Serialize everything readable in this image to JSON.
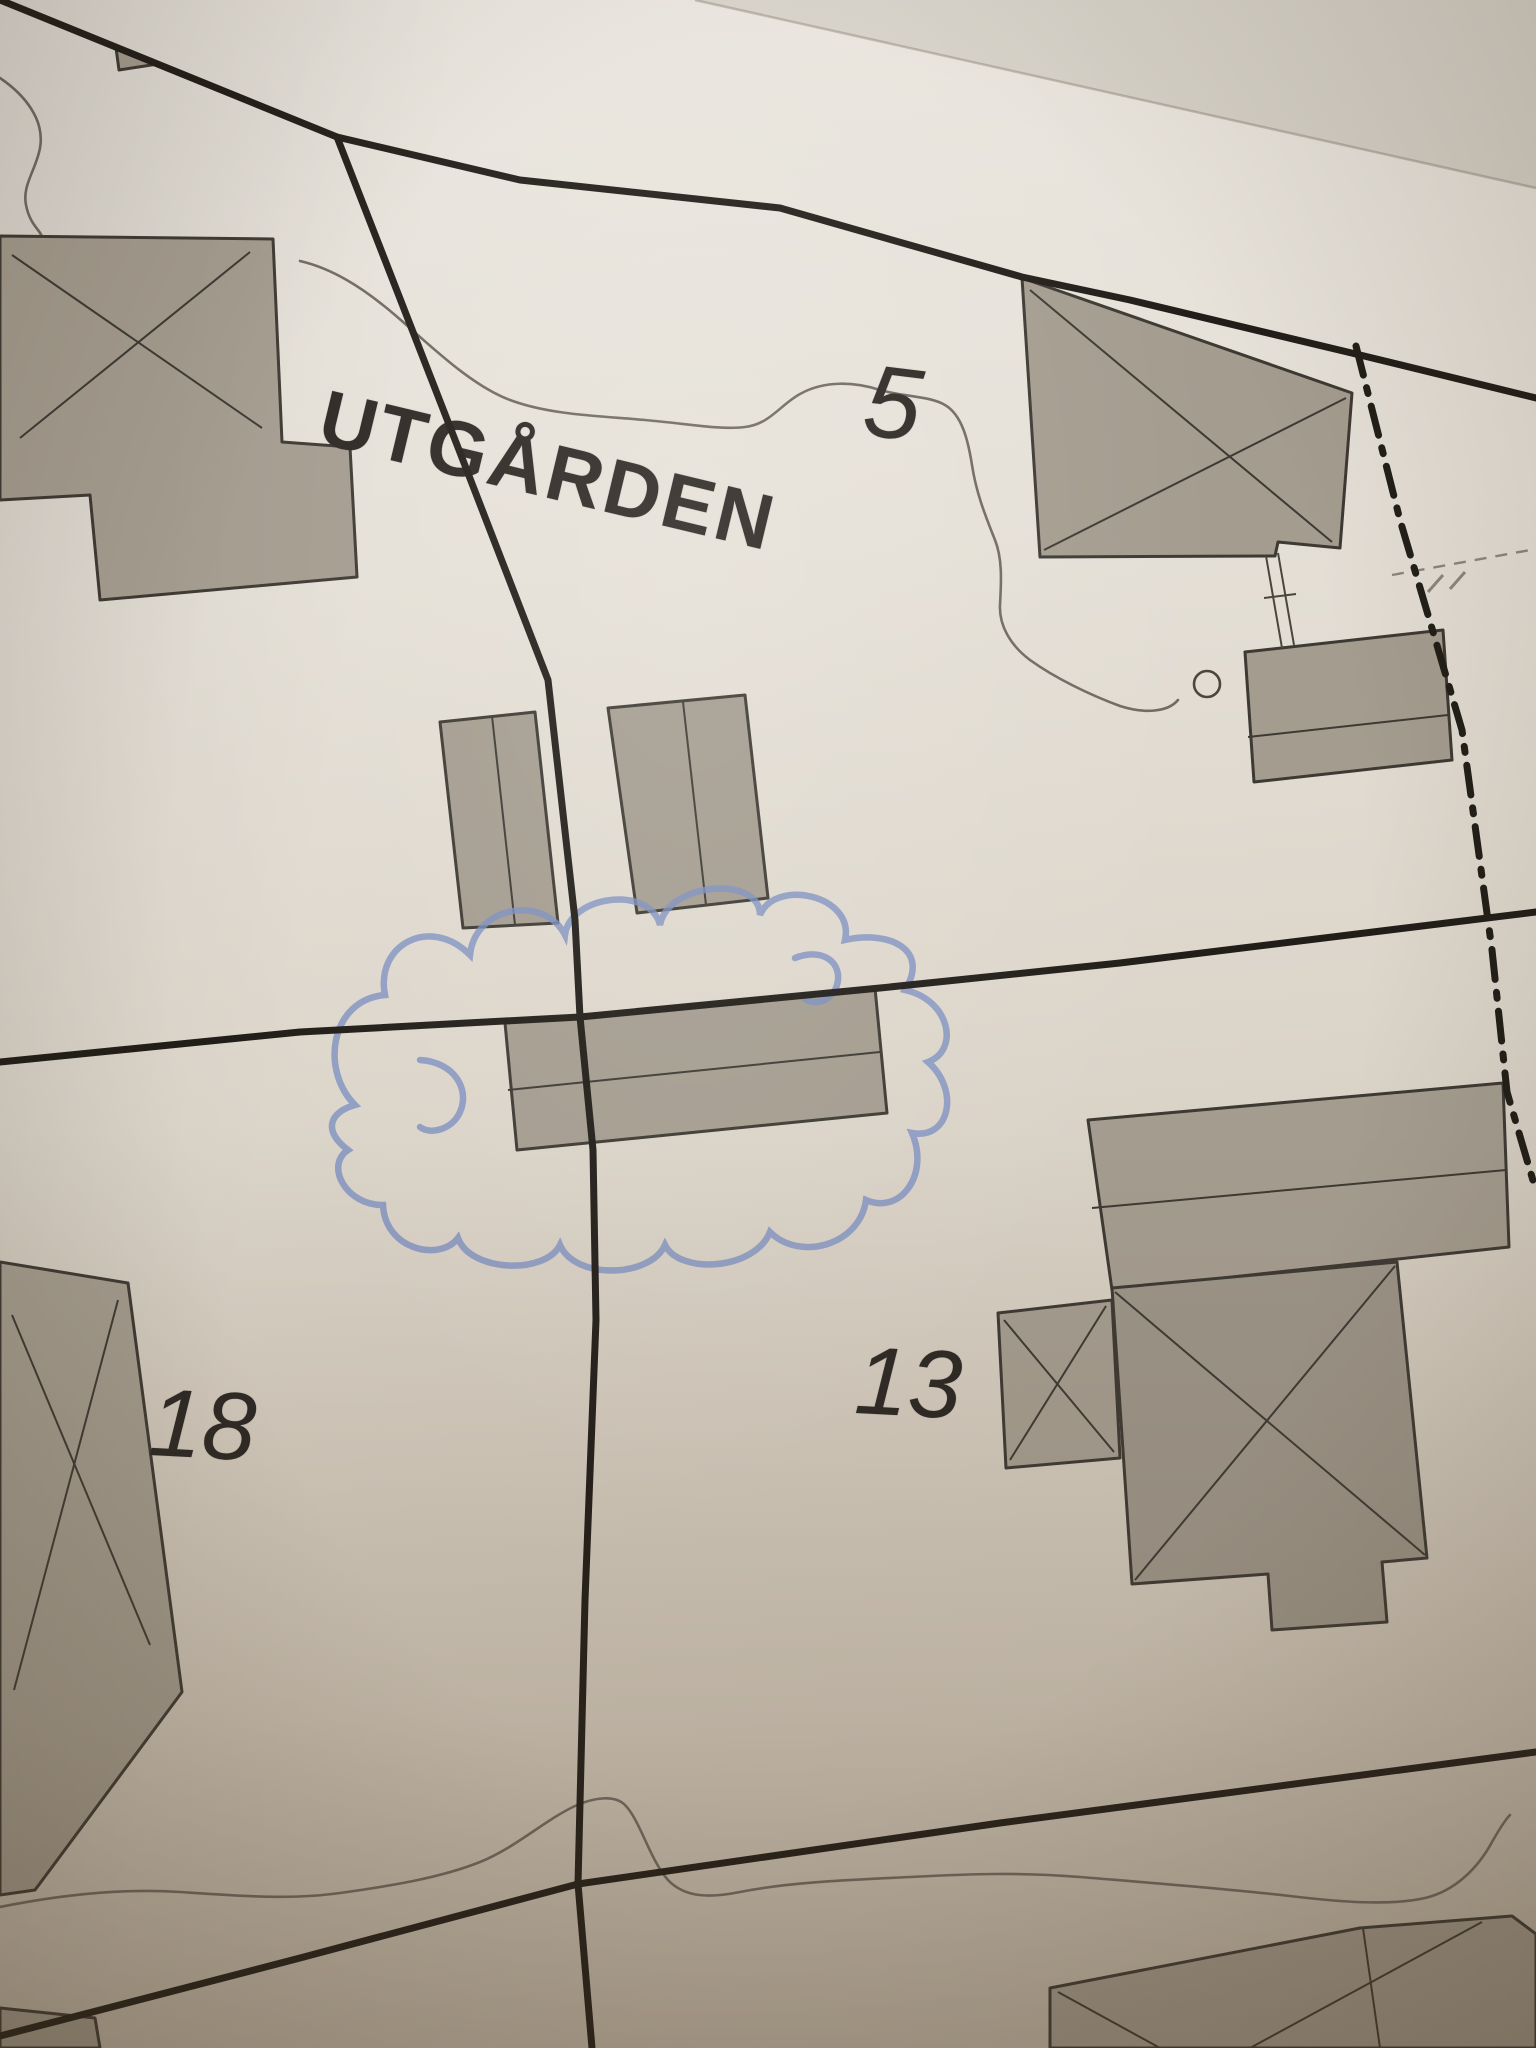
{
  "map": {
    "type": "cadastral-property-map-photo",
    "place_label": "UTGÅRDEN",
    "parcels": [
      {
        "number": "5"
      },
      {
        "number": "18"
      },
      {
        "number": "13"
      }
    ],
    "annotation": {
      "kind": "hand-drawn cloud circling an outbuilding",
      "color": "#7b8ec0"
    },
    "symbols": [
      {
        "name": "building-footprint-with-x"
      },
      {
        "name": "outbuilding-footprint"
      },
      {
        "name": "well-circle"
      },
      {
        "name": "municipal-boundary-dash-dot"
      },
      {
        "name": "contour-line"
      },
      {
        "name": "fence-double-line"
      }
    ]
  },
  "colors": {
    "paper_top": "#eae6df",
    "paper_bottom": "#c0b6a7",
    "building_fill": "#a49c8f",
    "building_fill_dark": "#9c9488",
    "line_ink": "#211d18",
    "building_outline": "#3d3933",
    "contour_gray": "#6f6961",
    "cloud_blue": "#7b8ec0"
  }
}
